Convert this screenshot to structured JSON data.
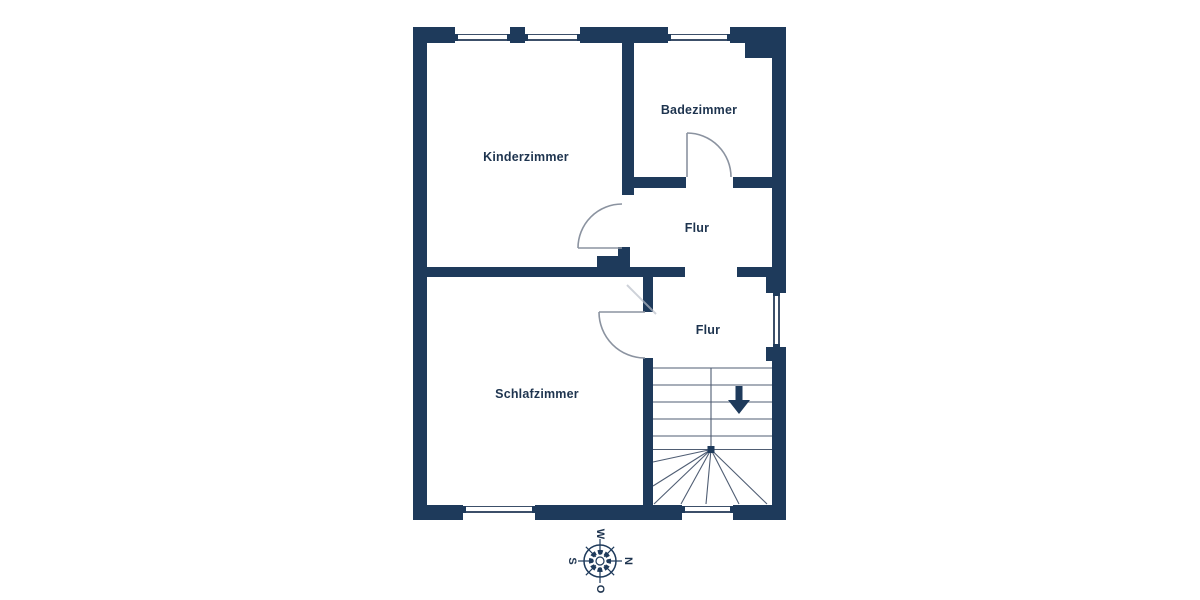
{
  "page": {
    "background": "#ffffff"
  },
  "floorplan": {
    "colors": {
      "wall": "#1e3a5b",
      "label": "#1e344f",
      "stair_line": "#4f5d73",
      "door_line": "#8b93a0",
      "window_line": "#3c4f69"
    },
    "rooms": {
      "kinderzimmer": {
        "label": "Kinderzimmer"
      },
      "badezimmer": {
        "label": "Badezimmer"
      },
      "flur_upper": {
        "label": "Flur"
      },
      "flur_lower": {
        "label": "Flur"
      },
      "schlafzimmer": {
        "label": "Schlafzimmer"
      }
    },
    "stairs": {
      "icon": "stairs-down-arrow-icon",
      "direction": "down"
    },
    "compass": {
      "top": "W",
      "right": "N",
      "bottom": "O",
      "left": "S"
    }
  }
}
